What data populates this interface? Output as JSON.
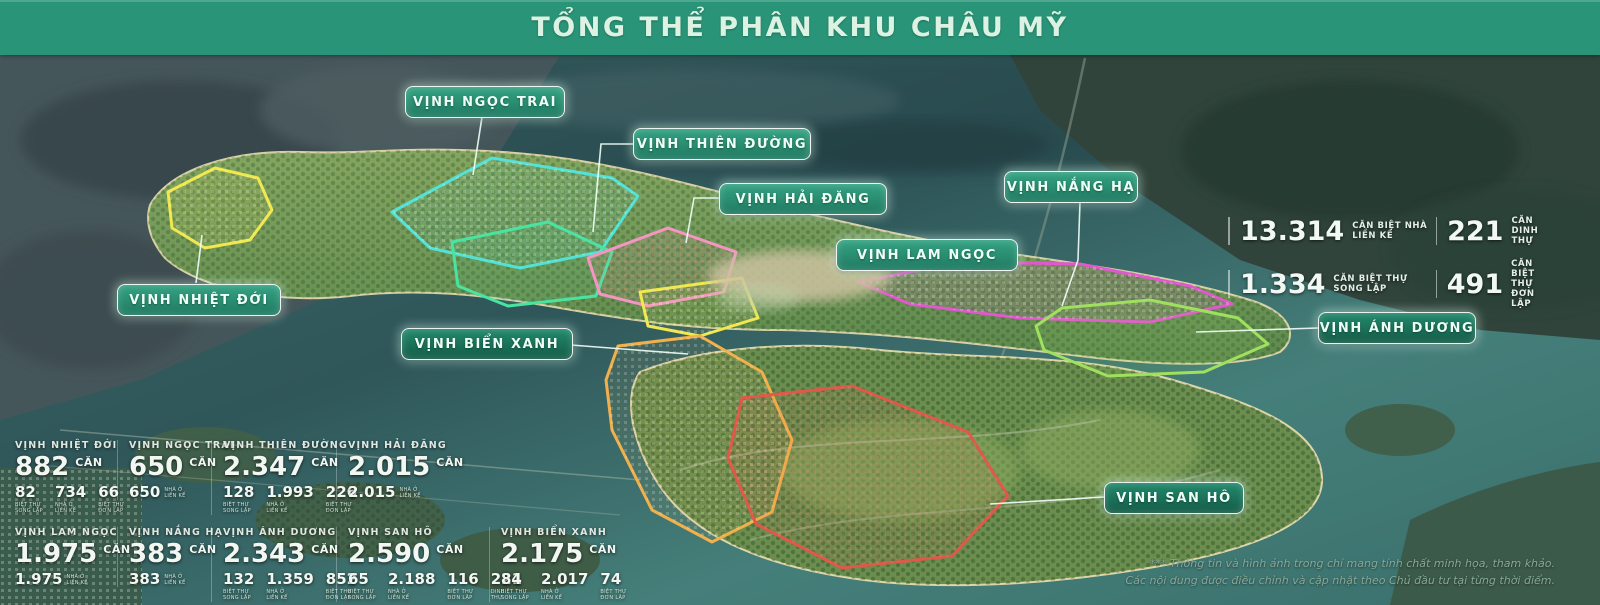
{
  "title": "TỔNG THỂ PHÂN KHU CHÂU MỸ",
  "overview": {
    "heading": "KỲ QUAN CHÂU MỸ",
    "area": {
      "value": "935",
      "unit": "HA"
    },
    "total": {
      "value": "15.139",
      "unit": "CĂN"
    },
    "breakdown": [
      {
        "value": "13.314",
        "label1": "CĂN BIỆT NHÀ",
        "label2": "LIỀN KẾ"
      },
      {
        "value": "221",
        "label1": "CĂN",
        "label2": "DINH THỰ"
      },
      {
        "value": "1.334",
        "label1": "CĂN BIỆT THỰ",
        "label2": "SONG LẬP"
      },
      {
        "value": "491",
        "label1": "CĂN BIỆT THỰ",
        "label2": "ĐƠN LẬP"
      }
    ]
  },
  "map": {
    "labels": [
      {
        "id": "ngoc-trai",
        "text": "VỊNH NGỌC TRAI"
      },
      {
        "id": "thien-duong",
        "text": "VỊNH THIÊN ĐƯỜNG"
      },
      {
        "id": "hai-dang",
        "text": "VỊNH HẢI ĐĂNG"
      },
      {
        "id": "nang-ha",
        "text": "VỊNH NẮNG HẠ"
      },
      {
        "id": "lam-ngoc",
        "text": "VỊNH LAM NGỌC"
      },
      {
        "id": "nhiet-doi",
        "text": "VỊNH NHIỆT ĐỚI"
      },
      {
        "id": "bien-xanh",
        "text": "VỊNH BIỂN XANH"
      },
      {
        "id": "anh-duong",
        "text": "VỊNH ÁNH DƯƠNG"
      },
      {
        "id": "san-ho",
        "text": "VỊNH SAN HÔ"
      }
    ]
  },
  "stats": {
    "row1": [
      {
        "name": "VỊNH NHIỆT ĐỚI",
        "total": "882",
        "unit": "CĂN",
        "parts": [
          {
            "value": "82",
            "label1": "BIỆT THỰ",
            "label2": "SONG LẬP"
          },
          {
            "value": "734",
            "label1": "NHÀ Ở",
            "label2": "LIỀN KẾ"
          },
          {
            "value": "66",
            "label1": "BIỆT THỰ",
            "label2": "ĐƠN LẬP"
          }
        ]
      },
      {
        "name": "VỊNH NGỌC TRAI",
        "total": "650",
        "unit": "CĂN",
        "parts": [
          {
            "value": "650",
            "label1": "NHÀ Ở",
            "label2": "LIỀN KẾ"
          }
        ]
      },
      {
        "name": "VỊNH THIÊN ĐƯỜNG",
        "total": "2.347",
        "unit": "CĂN",
        "parts": [
          {
            "value": "128",
            "label1": "BIỆT THỰ",
            "label2": "SONG LẬP"
          },
          {
            "value": "1.993",
            "label1": "NHÀ Ở",
            "label2": "LIỀN KẾ"
          },
          {
            "value": "226",
            "label1": "BIỆT THỰ",
            "label2": "ĐƠN LẬP"
          }
        ]
      },
      {
        "name": "VỊNH HẢI ĐĂNG",
        "total": "2.015",
        "unit": "CĂN",
        "parts": [
          {
            "value": "2.015",
            "label1": "NHÀ Ở",
            "label2": "LIỀN KẾ"
          }
        ]
      }
    ],
    "row2": [
      {
        "name": "VỊNH LAM NGỌC",
        "total": "1.975",
        "unit": "CĂN",
        "parts": [
          {
            "value": "1.975",
            "label1": "NHÀ Ở",
            "label2": "LIỀN KẾ"
          }
        ]
      },
      {
        "name": "VỊNH NẮNG HẠ",
        "total": "383",
        "unit": "CĂN",
        "parts": [
          {
            "value": "383",
            "label1": "NHÀ Ở",
            "label2": "LIỀN KẾ"
          }
        ]
      },
      {
        "name": "VỊNH ÁNH DƯƠNG",
        "total": "2.343",
        "unit": "CĂN",
        "parts": [
          {
            "value": "132",
            "label1": "BIỆT THỰ",
            "label2": "SONG LẬP"
          },
          {
            "value": "1.359",
            "label1": "NHÀ Ở",
            "label2": "LIỀN KẾ"
          },
          {
            "value": "852",
            "label1": "BIỆT THỰ",
            "label2": "ĐƠN LẬP"
          }
        ]
      },
      {
        "name": "VỊNH SAN HÔ",
        "total": "2.590",
        "unit": "CĂN",
        "parts": [
          {
            "value": "65",
            "label1": "BIỆT THỰ",
            "label2": "SONG LẬP"
          },
          {
            "value": "2.188",
            "label1": "NHÀ Ở",
            "label2": "LIỀN KẾ"
          },
          {
            "value": "116",
            "label1": "BIỆT THỰ",
            "label2": "ĐƠN LẬP"
          },
          {
            "value": "221",
            "label1": "DINH",
            "label2": "THỰ"
          }
        ]
      },
      {
        "name": "VỊNH BIỂN XANH",
        "total": "2.175",
        "unit": "CĂN",
        "parts": [
          {
            "value": "84",
            "label1": "BIỆT THỰ",
            "label2": "SONG LẬP"
          },
          {
            "value": "2.017",
            "label1": "NHÀ Ở",
            "label2": "LIỀN KẾ"
          },
          {
            "value": "74",
            "label1": "BIỆT THỰ",
            "label2": "ĐƠN LẬP"
          }
        ]
      }
    ]
  },
  "disclaimer": {
    "line1": "*** Thông tin và hình ảnh trong chỉ mang tính chất minh họa, tham khảo.",
    "line2": "Các nội dung được điều chỉnh và cập nhật theo Chủ đầu tư tại từng thời điểm."
  },
  "colors": {
    "header_bg": "#2a9478",
    "title_color": "#dcf2e2",
    "pill_bg_top": "#35a383",
    "pill_bg_bottom": "#1f7a61",
    "pill_dark_top": "#22896c",
    "pill_dark_bottom": "#145c47",
    "zone_yellow": "#f0e84e",
    "zone_cyan": "#52e2d8",
    "zone_green": "#49e3a2",
    "zone_pink": "#f495c4",
    "zone_magenta": "#e157cd",
    "zone_orange": "#f2b04a",
    "zone_red": "#e0584a",
    "zone_lime": "#9fe05e"
  }
}
